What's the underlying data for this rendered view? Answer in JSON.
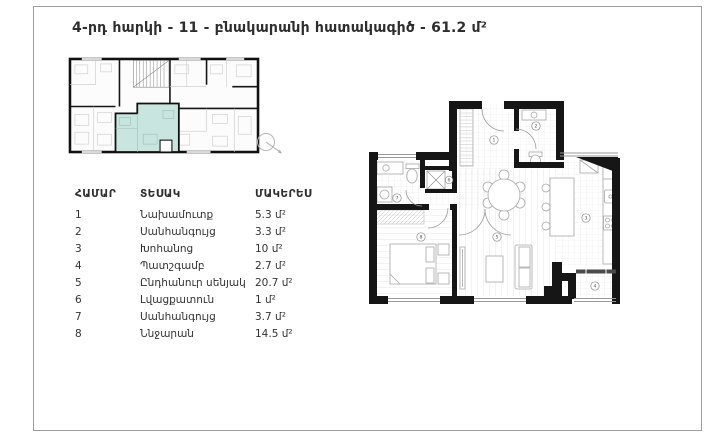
{
  "page": {
    "title": "4-րդ հարկի - 11 - բնակարանի հատակագիծ - 61.2 մ²"
  },
  "legend_table": {
    "headers": [
      "ՀԱՄԱՐ",
      "ՏԵՍԱԿ",
      "ՄԱԿԵՐԵՍ"
    ],
    "rows": [
      {
        "num": "1",
        "type": "Նախամուտք",
        "area": "5.3 մ²"
      },
      {
        "num": "2",
        "type": "Սանհանգույց",
        "area": "3.3 մ²"
      },
      {
        "num": "3",
        "type": "Խոհանոց",
        "area": "10 մ²"
      },
      {
        "num": "4",
        "type": "Պատշգամբ",
        "area": "2.7 մ²"
      },
      {
        "num": "5",
        "type": "Ընդհանուր սենյակ",
        "area": "20.7 մ²"
      },
      {
        "num": "6",
        "type": "Լվացքատուն",
        "area": "1 մ²"
      },
      {
        "num": "7",
        "type": "Սանհանգույց",
        "area": "3.7 մ²"
      },
      {
        "num": "8",
        "type": "Ննջարան",
        "area": "14.5 մ²"
      }
    ]
  },
  "floor_plan": {
    "room_numbers": [
      "1",
      "2",
      "3",
      "4",
      "5",
      "6",
      "7",
      "8"
    ],
    "highlight_color": "#c9e5df",
    "wall_color": "#161616"
  }
}
